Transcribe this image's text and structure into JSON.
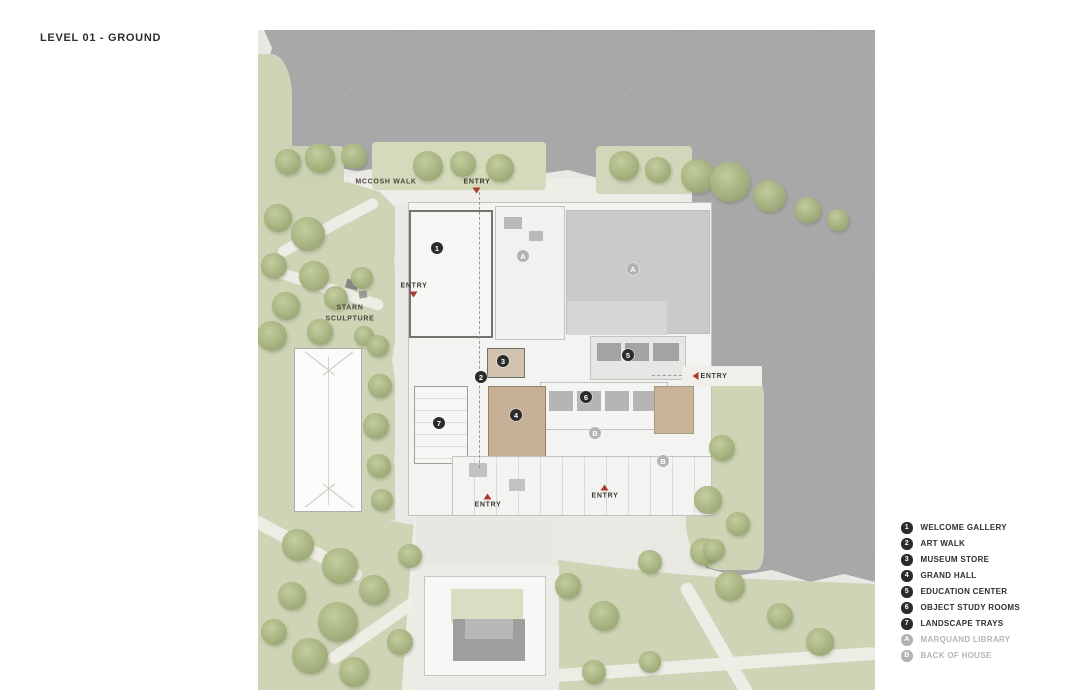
{
  "title": "LEVEL 01 - GROUND",
  "legend": {
    "items": [
      {
        "symbol": "1",
        "label": "WELCOME GALLERY",
        "muted": false
      },
      {
        "symbol": "2",
        "label": "ART WALK",
        "muted": false
      },
      {
        "symbol": "3",
        "label": "MUSEUM STORE",
        "muted": false
      },
      {
        "symbol": "4",
        "label": "GRAND HALL",
        "muted": false
      },
      {
        "symbol": "5",
        "label": "EDUCATION CENTER",
        "muted": false
      },
      {
        "symbol": "6",
        "label": "OBJECT STUDY ROOMS",
        "muted": false
      },
      {
        "symbol": "7",
        "label": "LANDSCAPE TRAYS",
        "muted": false
      },
      {
        "symbol": "A",
        "label": "MARQUAND LIBRARY",
        "muted": true
      },
      {
        "symbol": "B",
        "label": "BACK OF HOUSE",
        "muted": true
      }
    ]
  },
  "map": {
    "place_labels": [
      {
        "id": "mccosh-walk",
        "text": "MCCOSH WALK",
        "x": 128,
        "y": 152,
        "wrap": false
      },
      {
        "id": "starn-sculpture",
        "text": "STARN SCULPTURE",
        "x": 92,
        "y": 284,
        "wrap": true
      }
    ],
    "entry_labels": [
      {
        "text": "ENTRY",
        "x": 219,
        "y": 156,
        "arrow": "down"
      },
      {
        "text": "ENTRY",
        "x": 156,
        "y": 260,
        "arrow": "down"
      },
      {
        "text": "ENTRY",
        "x": 452,
        "y": 346,
        "arrow": "left"
      },
      {
        "text": "ENTRY",
        "x": 230,
        "y": 471,
        "arrow": "up"
      },
      {
        "text": "ENTRY",
        "x": 347,
        "y": 462,
        "arrow": "up"
      }
    ],
    "markers": [
      {
        "symbol": "1",
        "x": 179,
        "y": 218,
        "muted": false
      },
      {
        "symbol": "2",
        "x": 223,
        "y": 347,
        "muted": false
      },
      {
        "symbol": "3",
        "x": 245,
        "y": 331,
        "muted": false
      },
      {
        "symbol": "4",
        "x": 258,
        "y": 385,
        "muted": false
      },
      {
        "symbol": "5",
        "x": 370,
        "y": 325,
        "muted": false
      },
      {
        "symbol": "6",
        "x": 328,
        "y": 367,
        "muted": false
      },
      {
        "symbol": "7",
        "x": 181,
        "y": 393,
        "muted": false
      },
      {
        "symbol": "A",
        "x": 265,
        "y": 226,
        "muted": true
      },
      {
        "symbol": "A",
        "x": 375,
        "y": 239,
        "muted": true
      },
      {
        "symbol": "B",
        "x": 337,
        "y": 403,
        "muted": true
      },
      {
        "symbol": "B",
        "x": 405,
        "y": 431,
        "muted": true
      }
    ]
  },
  "colors": {
    "accent_red": "#a93a2c",
    "marker_black": "#2b2b2b",
    "marker_muted": "#b3b3b1",
    "context_gray": "#a9a9a9",
    "lawn_green": "#cfd4b7",
    "building_white": "#f3f3f1",
    "roof_gray": "#cacac8",
    "grand_hall_tan": "#c6b197",
    "title_text": "#2d2d2d",
    "muted_text": "#b5b5b5"
  }
}
